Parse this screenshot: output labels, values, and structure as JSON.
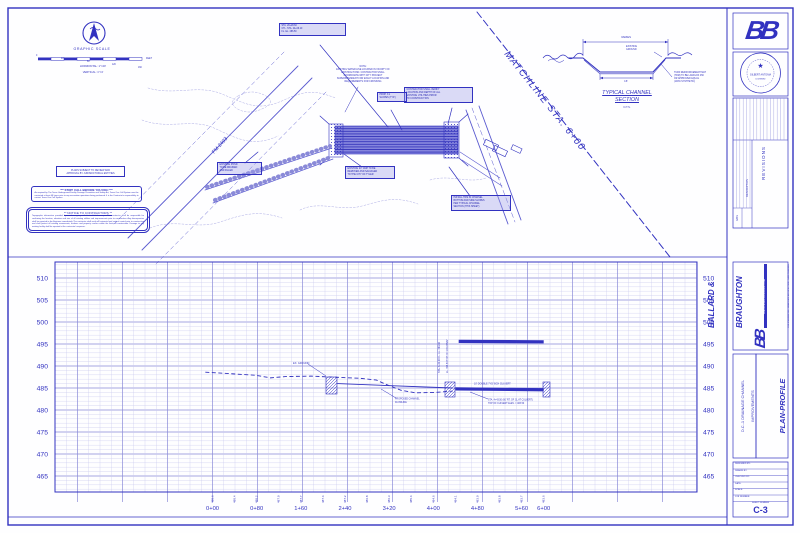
{
  "colors": {
    "ink": "#3232c0",
    "ink_light": "#9a9ae0",
    "grid_minor": "#c9c9ee",
    "grid_major": "#8a8ad8",
    "band": "#7d7ddd",
    "paper": "#fefeff"
  },
  "sheet": {
    "number": "C-3"
  },
  "graphic_scale": {
    "title": "GRAPHIC SCALE",
    "numbers": [
      "0",
      "40",
      "80",
      "120",
      "160"
    ],
    "unit": "FEET",
    "horizontal": "HORIZONTAL:  1\"=40'",
    "vertical": "VERTICAL:  1\"=4'"
  },
  "notices": {
    "review": {
      "line1": "PLANS SUBJECT TO REVIEW AND",
      "line2": "APPROVAL BY JURISDICTIONAL ENTITIES"
    },
    "stop": {
      "title": "***  STOP!  CALL BEFORE YOU DIG!  ***",
      "body": "As required by The Texas Underground Facility Damage Prevention and Safety Act, Texas One Call System must be contacted at least 48 hours prior to any excavation operations being performed. It is the Contractor's responsibility to contact Texas One Call System."
    },
    "contractors": {
      "title": "**   NOTICE TO CONTRACTORS   **",
      "body": "Topographic information provided by aerial mapping with limited field surveys. The contractor shall be responsible for confirming the location, elevation and size of all existing utilities and improvements prior to construction. Any discrepancies shall be reported to the Engineer immediately. The contractor shall verify all horizontal and vertical control prior to construction and shall protect all existing monuments, markers and property corners within the limits of construction. Damage to any existing facility shall be repaired at the contractor's expense."
    }
  },
  "plan": {
    "road_label": "FM 2493",
    "matchline_label": "MATCHLINE STA. 6+00",
    "waterline_note": [
      "NOTE:",
      "EXISTING WATER LINE LOCATED IN VICINITY OF",
      "EXISTING POND.  CONTRACTOR SHALL",
      "COORDINATE WITH CITY PROJECT",
      "SUPERINTENDENT FOR EXACT LOCATION AND",
      "REQUIREMENTS FOR CROSSING"
    ],
    "callouts": {
      "c1": [
        "STA. 20+28.60",
        "CTL. STA. 24+06.10",
        "FL. EL. 486.50"
      ],
      "c2": [
        "EXISTING POND",
        "TO BE DRAINED",
        "AND FILLED"
      ],
      "c3": [
        "EXISTING 24\" CMP TO BE",
        "REMOVED AND SALVAGED",
        "TO THE CITY OF TYLER"
      ],
      "c4": [
        "CONTRACTOR SHALL VERIFY",
        "LOCATION AND DEPTH OF ALL",
        "EXISTING UTILITIES PRIOR",
        "TO CONSTRUCTION"
      ],
      "c5": [
        "PROP. 3:1",
        "SLOPES (TYP.)"
      ],
      "c6": [
        "INSTALL TRM IN CHANNEL",
        "BOTTOM AND SIDE SLOPES",
        "PER TYPICAL CHANNEL",
        "SECTION (THIS SHEET)"
      ]
    }
  },
  "section": {
    "varies": "VARIES",
    "existing_ground": [
      "EXISTING",
      "GROUND"
    ],
    "bottom_dim": "16'",
    "trm_note": [
      "TURF REINFORCEMENT MAT",
      "(TRM) TO BE LANDLOK 450",
      "OR APPROVED EQUAL",
      "(100% SYNTHETIC)"
    ],
    "title": [
      "TYPICAL CHANNEL",
      "SECTION"
    ],
    "nts": "N.T.S."
  },
  "profile_labels": {
    "ex_ground": "EX. GROUND",
    "proposed": [
      "PROPOSED CHANNEL",
      "FLOWLINE"
    ],
    "culvert": "10' DOUBLE 7'X5' BOX CULVERT",
    "culvert_note": [
      "STA. 4+43.50 (60' RT. OF CL AT CULVERT)",
      "TOP OF CULVERT ELEV. = 483.50"
    ],
    "rot1": "STA. 4+32.00  FL. EL. 483.80",
    "rot2": "EL. 495.50  TOP OF ROADWAY"
  },
  "title_block": {
    "logo": "BB",
    "seal_star": "★",
    "seal_name": "GILBERT ANTONIA",
    "seal_sub": "LICENSED",
    "revisions": {
      "title": "REVISIONS",
      "description": "DESCRIPTION",
      "date": "DATE"
    },
    "company": {
      "name1": "BALLARD &",
      "name2": "BRAUGHTON",
      "bar": "A REGISTERED ENGINEERING FIRM",
      "tagline1": "CIVIL ENGINEERING - LANDSCAPE ARCHITECTURE - LAND PLANNING",
      "tagline2": "TYLER, TEXAS"
    },
    "project": {
      "name1": "D.C.-1 DRAINAGE CHANNEL",
      "name2": "IMPROVEMENTS",
      "title1": "PLAN-PROFILE",
      "title2": "STA. 0+00 TO STA. 6+00"
    },
    "info_rows": [
      "DESIGNED BY:",
      "DRAWN BY:",
      "CHECKED BY:",
      "DATE:",
      "SCALE:",
      "JOB NUMBER:"
    ],
    "sheet_label": "SHEET NUMBER",
    "sheet_number": "C-3"
  },
  "chart_data": {
    "type": "line",
    "title": "PROFILE STA. 0+00 TO STA. 6+00",
    "xlabel": "STATION",
    "ylabel": "ELEVATION (FT)",
    "grid": true,
    "y_ticks": [
      510,
      505,
      500,
      495,
      490,
      485,
      480,
      475,
      470,
      465
    ],
    "ylim": [
      461,
      514
    ],
    "x_ticks": [
      "0+00",
      "0+80",
      "1+60",
      "2+40",
      "3+20",
      "4+00",
      "4+80",
      "5+60",
      "6+00"
    ],
    "flowline_elevs": [
      "488.6",
      "488.4",
      "488.2",
      "487.9",
      "487.7",
      "487.4",
      "487.2",
      "486.8",
      "486.3",
      "485.4",
      "484.6",
      "484.1",
      "483.9",
      "483.8",
      "483.7",
      "483.6"
    ],
    "series": [
      {
        "name": "EXISTING GROUND",
        "style": "dashed",
        "x_ft": [
          -13,
          78,
          105,
          132,
          178,
          232,
          268,
          297,
          313,
          341,
          368,
          404,
          435
        ],
        "elev": [
          488.6,
          487.9,
          487.3,
          487.6,
          487.7,
          487.4,
          487.2,
          486.8,
          485.9,
          484.5,
          483.9,
          484.0,
          484.3
        ]
      },
      {
        "name": "PROPOSED CHANNEL FLOWLINE",
        "style": "solid",
        "x_ft": [
          226,
          435
        ],
        "elev": [
          486.0,
          485.0
        ]
      },
      {
        "name": "TOP OF ROADWAY",
        "style": "band",
        "x_ft": [
          446,
          600
        ],
        "elev": [
          495.6,
          495.5
        ]
      },
      {
        "name": "BOX CULVERT",
        "style": "band",
        "x_ft": [
          440,
          600
        ],
        "elev": [
          484.8,
          484.6
        ]
      }
    ]
  }
}
